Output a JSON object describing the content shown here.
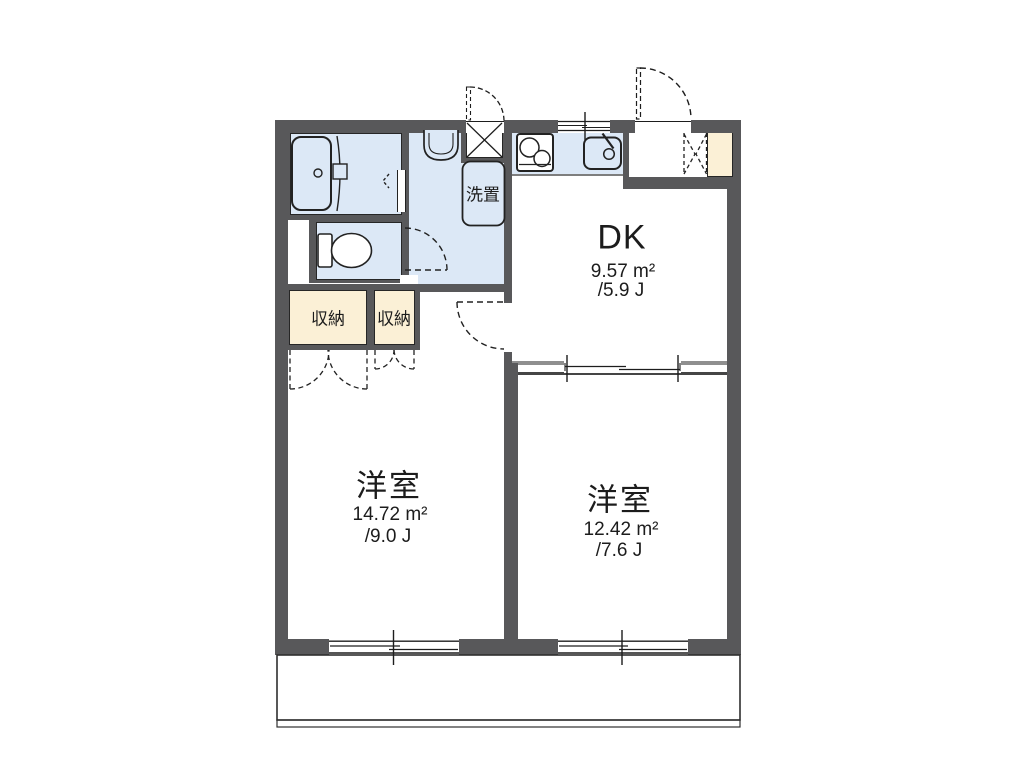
{
  "floorplan": {
    "labels": {
      "dk": {
        "title": "DK",
        "area": "9.57 m²",
        "jo": "/5.9 J"
      },
      "room_left": {
        "title": "洋室",
        "area": "14.72 m²",
        "jo": "/9.0 J"
      },
      "room_right": {
        "title": "洋室",
        "area": "12.42 m²",
        "jo": "/7.6 J"
      },
      "closet_left": "収納",
      "closet_right": "収納",
      "laundry": "洗置"
    },
    "colors": {
      "wall": "#58585a",
      "water_area": "#dce8f6",
      "storage": "#fbf0d6",
      "floor": "#ffffff",
      "line": "#222222"
    }
  }
}
